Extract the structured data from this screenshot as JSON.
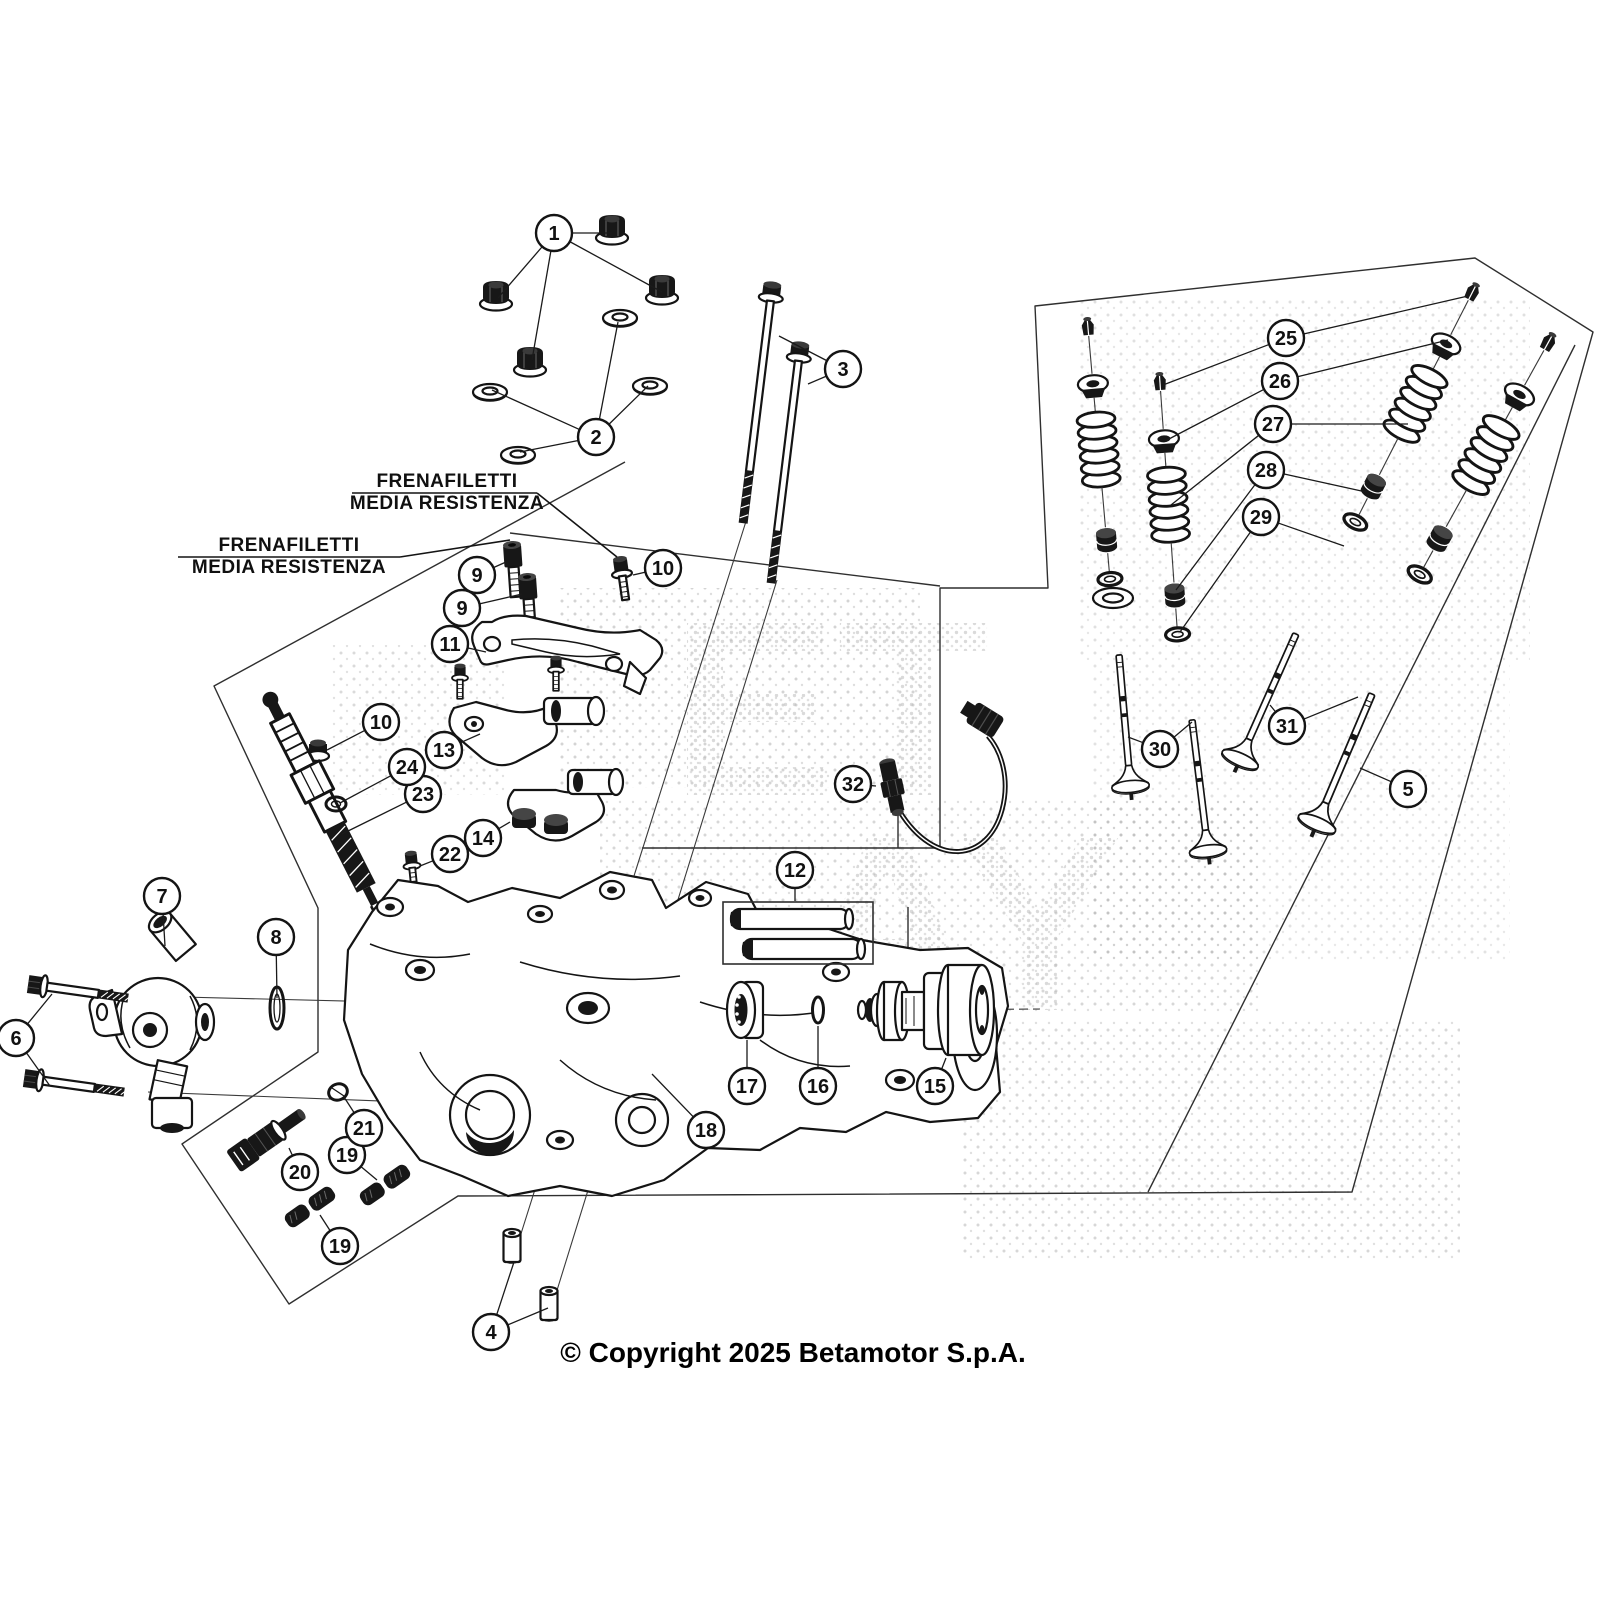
{
  "page": {
    "width": 1600,
    "height": 1600,
    "background": "#ffffff",
    "line_color": "#1a1a1a"
  },
  "copyright": "© Copyright 2025 Betamotor S.p.A.",
  "watermark": {
    "letters": [
      {
        "text": "ET",
        "x": 830,
        "y": 795,
        "size": 250
      },
      {
        "text": "AY",
        "x": 960,
        "y": 1010,
        "size": 250
      }
    ]
  },
  "annotations": [
    {
      "line1": "FRENAFILETTI",
      "line2": "MEDIA RESISTENZA",
      "cx": 447,
      "y1": 487,
      "y2": 509,
      "rule": [
        352,
        493,
        537,
        493
      ],
      "leader": [
        [
          537,
          493
        ],
        [
          617,
          557
        ]
      ]
    },
    {
      "line1": "FRENAFILETTI",
      "line2": "MEDIA RESISTENZA",
      "cx": 289,
      "y1": 551,
      "y2": 573,
      "rule": [
        178,
        557,
        400,
        557
      ],
      "leader": [
        [
          400,
          557
        ],
        [
          510,
          540
        ]
      ]
    }
  ],
  "callouts": [
    {
      "n": "1",
      "x": 554,
      "y": 233,
      "targets": [
        [
          612,
          233
        ],
        [
          498,
          298
        ],
        [
          662,
          292
        ],
        [
          532,
          360
        ]
      ]
    },
    {
      "n": "2",
      "x": 596,
      "y": 437,
      "targets": [
        [
          618,
          322
        ],
        [
          492,
          390
        ],
        [
          648,
          386
        ],
        [
          520,
          452
        ]
      ]
    },
    {
      "n": "3",
      "x": 843,
      "y": 369,
      "targets": [
        [
          779,
          336
        ],
        [
          808,
          384
        ]
      ]
    },
    {
      "n": "4",
      "x": 491,
      "y": 1332,
      "targets": [
        [
          514,
          1262
        ],
        [
          548,
          1308
        ]
      ]
    },
    {
      "n": "5",
      "x": 1408,
      "y": 789,
      "targets": [
        [
          1360,
          768
        ]
      ]
    },
    {
      "n": "6",
      "x": 16,
      "y": 1038,
      "targets": [
        [
          52,
          994
        ],
        [
          50,
          1086
        ]
      ]
    },
    {
      "n": "7",
      "x": 162,
      "y": 896,
      "targets": [
        [
          165,
          946
        ]
      ]
    },
    {
      "n": "8",
      "x": 276,
      "y": 937,
      "targets": [
        [
          277,
          998
        ]
      ]
    },
    {
      "n": "9",
      "x": 477,
      "y": 575,
      "targets": [
        [
          506,
          562
        ]
      ]
    },
    {
      "n": "9",
      "x": 462,
      "y": 608,
      "targets": [
        [
          522,
          594
        ]
      ]
    },
    {
      "n": "10",
      "x": 663,
      "y": 568,
      "targets": [
        [
          633,
          575
        ]
      ]
    },
    {
      "n": "10",
      "x": 381,
      "y": 722,
      "targets": [
        [
          327,
          750
        ]
      ]
    },
    {
      "n": "11",
      "x": 450,
      "y": 644,
      "targets": [
        [
          486,
          652
        ]
      ]
    },
    {
      "n": "12",
      "x": 795,
      "y": 870,
      "targets": [
        [
          795,
          901
        ]
      ]
    },
    {
      "n": "13",
      "x": 444,
      "y": 750,
      "targets": [
        [
          480,
          734
        ]
      ]
    },
    {
      "n": "14",
      "x": 483,
      "y": 838,
      "targets": [
        [
          510,
          822
        ]
      ]
    },
    {
      "n": "15",
      "x": 935,
      "y": 1086,
      "targets": [
        [
          946,
          1058
        ]
      ]
    },
    {
      "n": "16",
      "x": 818,
      "y": 1086,
      "targets": [
        [
          818,
          1026
        ]
      ]
    },
    {
      "n": "17",
      "x": 747,
      "y": 1086,
      "targets": [
        [
          747,
          1040
        ]
      ]
    },
    {
      "n": "18",
      "x": 706,
      "y": 1130,
      "targets": [
        [
          652,
          1074
        ]
      ]
    },
    {
      "n": "19",
      "x": 347,
      "y": 1155,
      "targets": [
        [
          377,
          1180
        ]
      ]
    },
    {
      "n": "19",
      "x": 340,
      "y": 1246,
      "targets": [
        [
          320,
          1215
        ]
      ]
    },
    {
      "n": "20",
      "x": 300,
      "y": 1172,
      "targets": [
        [
          289,
          1148
        ]
      ]
    },
    {
      "n": "21",
      "x": 364,
      "y": 1128,
      "targets": [
        [
          344,
          1097
        ]
      ]
    },
    {
      "n": "22",
      "x": 450,
      "y": 854,
      "targets": [
        [
          420,
          866
        ]
      ]
    },
    {
      "n": "23",
      "x": 423,
      "y": 794,
      "targets": [
        [
          342,
          834
        ]
      ]
    },
    {
      "n": "24",
      "x": 407,
      "y": 767,
      "targets": [
        [
          340,
          803
        ]
      ]
    },
    {
      "n": "25",
      "x": 1286,
      "y": 338,
      "targets": [
        [
          1468,
          296
        ],
        [
          1163,
          385
        ]
      ]
    },
    {
      "n": "26",
      "x": 1280,
      "y": 381,
      "targets": [
        [
          1448,
          340
        ],
        [
          1167,
          440
        ]
      ]
    },
    {
      "n": "27",
      "x": 1273,
      "y": 424,
      "targets": [
        [
          1408,
          424
        ],
        [
          1171,
          505
        ]
      ]
    },
    {
      "n": "28",
      "x": 1266,
      "y": 470,
      "targets": [
        [
          1366,
          492
        ],
        [
          1176,
          590
        ]
      ]
    },
    {
      "n": "29",
      "x": 1261,
      "y": 517,
      "targets": [
        [
          1344,
          546
        ],
        [
          1180,
          632
        ]
      ]
    },
    {
      "n": "30",
      "x": 1160,
      "y": 749,
      "targets": [
        [
          1128,
          737
        ],
        [
          1192,
          722
        ]
      ]
    },
    {
      "n": "31",
      "x": 1287,
      "y": 726,
      "targets": [
        [
          1270,
          705
        ],
        [
          1358,
          697
        ]
      ]
    },
    {
      "n": "32",
      "x": 853,
      "y": 784,
      "targets": [
        [
          876,
          786
        ]
      ]
    }
  ]
}
